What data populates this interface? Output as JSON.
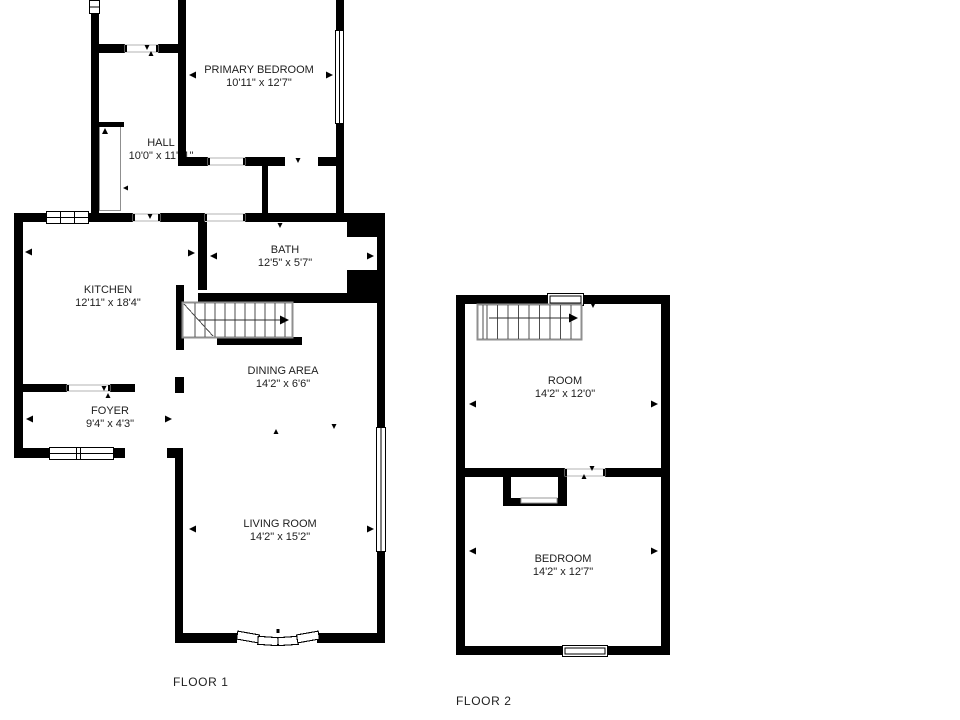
{
  "title": "Two-floor residential floor plan",
  "colors": {
    "wall": "#000000",
    "stair_outline": "#8f8f8f",
    "text": "#1e1e1e",
    "background": "#ffffff"
  },
  "floors": [
    {
      "label": "FLOOR 1",
      "rooms": [
        {
          "id": "primary-bedroom",
          "name": "PRIMARY BEDROOM",
          "dims": "10'11\" x 12'7\""
        },
        {
          "id": "hall",
          "name": "HALL",
          "dims": "10'0\" x 11'11\""
        },
        {
          "id": "bath",
          "name": "BATH",
          "dims": "12'5\" x 5'7\""
        },
        {
          "id": "kitchen",
          "name": "KITCHEN",
          "dims": "12'11\" x 18'4\""
        },
        {
          "id": "dining-area",
          "name": "DINING AREA",
          "dims": "14'2\" x 6'6\""
        },
        {
          "id": "foyer",
          "name": "FOYER",
          "dims": "9'4\" x 4'3\""
        },
        {
          "id": "living-room",
          "name": "LIVING ROOM",
          "dims": "14'2\" x 15'2\""
        }
      ]
    },
    {
      "label": "FLOOR 2",
      "rooms": [
        {
          "id": "room",
          "name": "ROOM",
          "dims": "14'2\" x 12'0\""
        },
        {
          "id": "bedroom",
          "name": "BEDROOM",
          "dims": "14'2\" x 12'7\""
        }
      ]
    }
  ]
}
